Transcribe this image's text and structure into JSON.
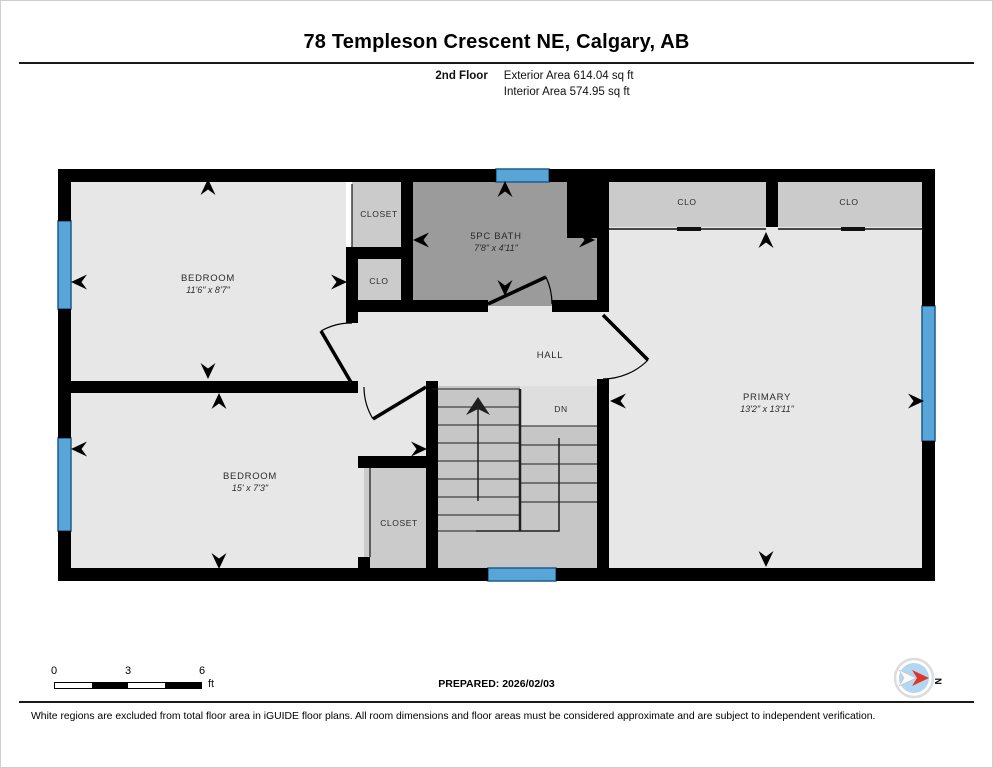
{
  "header": {
    "title": "78 Templeson Crescent NE, Calgary, AB",
    "floor_label": "2nd Floor",
    "exterior_area": "Exterior Area 614.04 sq ft",
    "interior_area": "Interior Area 574.95 sq ft"
  },
  "plan": {
    "rooms": {
      "bedroom_top": {
        "name": "BEDROOM",
        "dims": "11'6\" x 8'7\""
      },
      "bedroom_bottom": {
        "name": "BEDROOM",
        "dims": "15' x 7'3\""
      },
      "primary": {
        "name": "PRIMARY",
        "dims": "13'2\" x 13'11\""
      },
      "bath": {
        "name": "5PC BATH",
        "dims": "7'8\" x 4'11\""
      },
      "hall": {
        "name": "HALL"
      },
      "stairs": {
        "label": "DN"
      },
      "closet_top": {
        "name": "CLOSET"
      },
      "clo_left": {
        "name": "CLO"
      },
      "clo_right_1": {
        "name": "CLO"
      },
      "clo_right_2": {
        "name": "CLO"
      },
      "closet_bottom": {
        "name": "CLOSET"
      }
    },
    "colors": {
      "wall": "#000000",
      "room_fill": "#e7e7e7",
      "closet_fill": "#cbcbcb",
      "bath_fill": "#9b9b9b",
      "stairs_fill": "#c6c6c6",
      "window_blue": "#58a5d8"
    }
  },
  "footer": {
    "scale": {
      "ticks": [
        "0",
        "3",
        "6"
      ],
      "unit": "ft"
    },
    "prepared": "PREPARED: 2026/02/03",
    "compass_label": "N",
    "compass_needle_color": "#e0352b",
    "disclaimer": "White regions are excluded from total floor area in iGUIDE floor plans. All room dimensions and floor areas must be considered approximate and are subject to independent verification."
  }
}
